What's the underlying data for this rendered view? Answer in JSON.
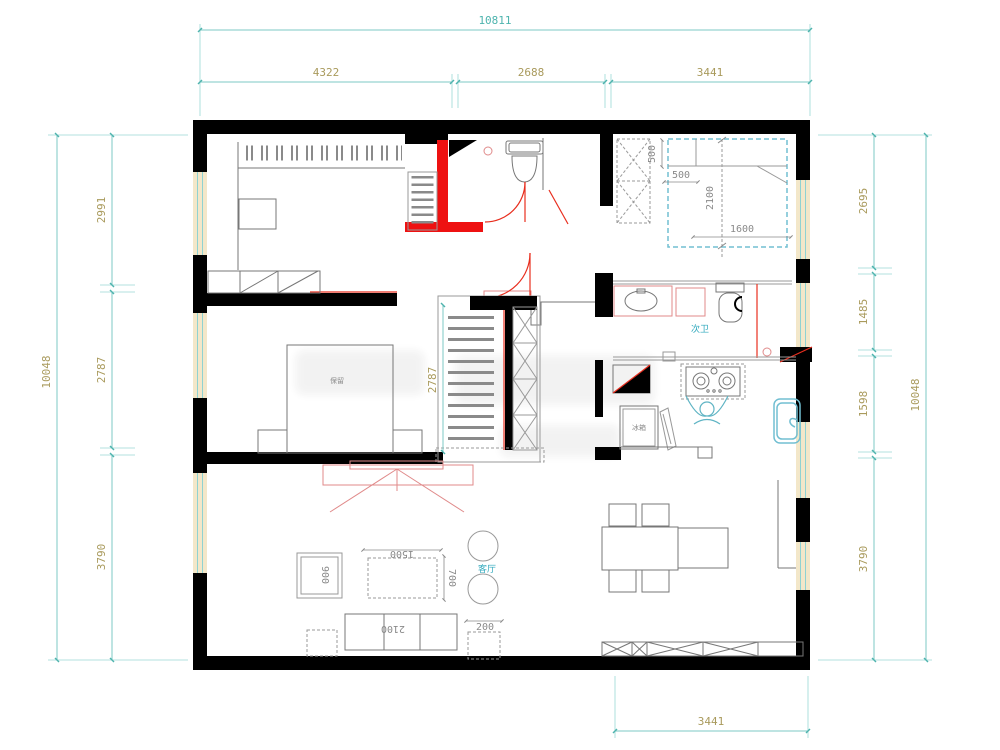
{
  "dims": {
    "top": {
      "overall": "10811",
      "seg1": "4322",
      "seg2": "2688",
      "seg3": "3441"
    },
    "left": {
      "overall": "10048",
      "seg1": "2991",
      "seg2": "2787",
      "seg3": "3790"
    },
    "right": {
      "overall": "10048",
      "seg1": "2695",
      "seg2": "1485",
      "seg3": "1598",
      "seg4": "3790"
    },
    "bottom": {
      "seg1": "3441"
    },
    "interior": {
      "hall_closet": "2787"
    },
    "bed": {
      "inset_top": "500",
      "inset_side": "500",
      "length": "2100",
      "width": "1600"
    },
    "furniture": {
      "side_table": "900",
      "coffee_w": "1500",
      "coffee_d": "700",
      "sofa": "2100",
      "end_table": "200"
    }
  },
  "labels": {
    "bath2": "次卫",
    "living": "客厅",
    "bed_note": "保留",
    "kitchen_box": "冰箱"
  }
}
